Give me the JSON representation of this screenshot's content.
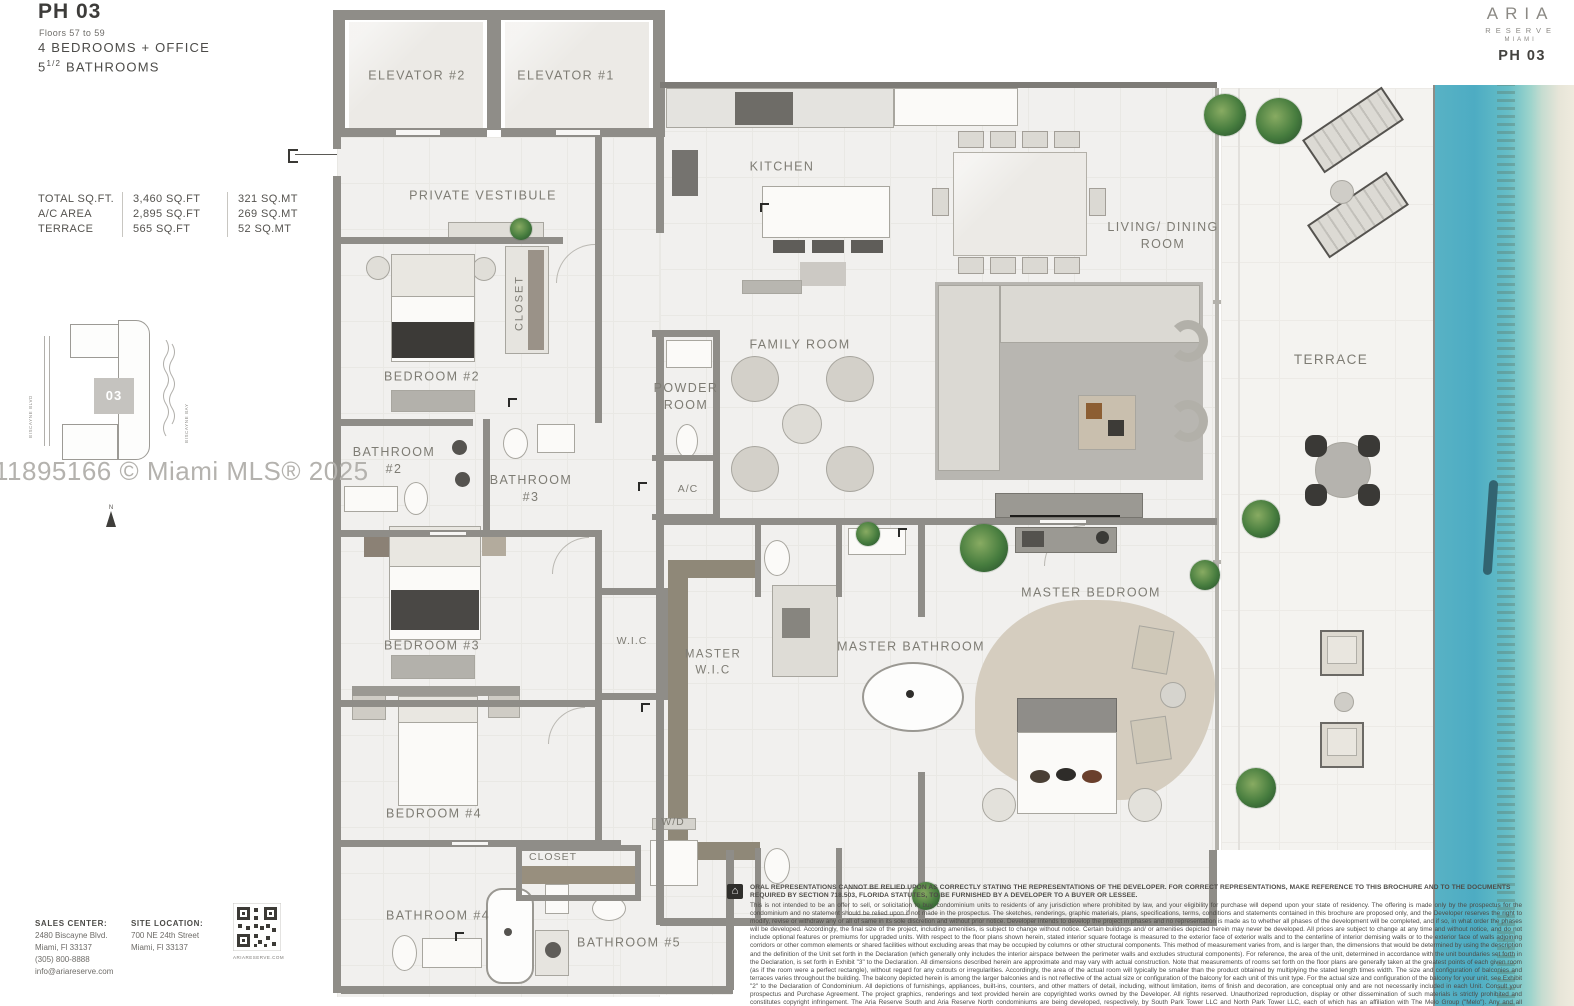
{
  "brand": {
    "name": "ARIA",
    "line2": "RESERVE",
    "line3": "MIAMI",
    "unit": "PH 03"
  },
  "left_panel": {
    "unit": "PH 03",
    "floors": "Floors 57 to 59",
    "bedrooms": "4 BEDROOMS + OFFICE",
    "bath_num": "5",
    "bath_frac": "1/2",
    "bath_word": " BATHROOMS",
    "stats": [
      {
        "label": "TOTAL SQ.FT.",
        "sqft": "3,460 SQ.FT",
        "sqmt": "321 SQ.MT"
      },
      {
        "label": "A/C AREA",
        "sqft": "2,895 SQ.FT",
        "sqmt": "269 SQ.MT"
      },
      {
        "label": "TERRACE",
        "sqft": "565 SQ.FT",
        "sqmt": "52 SQ.MT"
      }
    ],
    "site_diagram": {
      "left_label": "BISCAYNE BLVD",
      "right_label": "BISCAYNE BAY",
      "unit_number": "03",
      "north": "N"
    },
    "watermark": "11895166 © Miami MLS® 2025",
    "sales_center": {
      "title": "SALES CENTER:",
      "l1": "2480 Biscayne Blvd.",
      "l2": "Miami, Fl 33137",
      "l3": "(305) 800-8888",
      "l4": "info@ariareserve.com"
    },
    "site_location": {
      "title": "SITE LOCATION:",
      "l1": "700 NE 24th Street",
      "l2": "Miami, Fl 33137"
    },
    "qr_caption": "ARIARESERVE.COM"
  },
  "rooms": {
    "elevator2": "ELEVATOR #2",
    "elevator1": "ELEVATOR #1",
    "vestibule": "PRIVATE VESTIBULE",
    "kitchen": "KITCHEN",
    "living": "LIVING/ DINING\nROOM",
    "family": "FAMILY ROOM",
    "closet2": "CLOSET",
    "bedroom2": "BEDROOM #2",
    "powder": "POWDER\nROOM",
    "bath2": "BATHROOM\n#2",
    "bath3": "BATHROOM\n#3",
    "ac": "A/C",
    "terrace": "TERRACE",
    "bedroom3": "BEDROOM #3",
    "wic": "W.I.C",
    "master_wic": "MASTER\nW.I.C",
    "master_bath": "MASTER BATHROOM",
    "master_bed": "MASTER BEDROOM",
    "bedroom4": "BEDROOM #4",
    "wd": "W/D",
    "closet4": "CLOSET",
    "bath4": "BATHROOM #4",
    "bath5": "BATHROOM #5"
  },
  "disclaimer": {
    "headline": "ORAL REPRESENTATIONS CANNOT BE RELIED UPON AS CORRECTLY STATING THE REPRESENTATIONS OF THE DEVELOPER. FOR CORRECT REPRESENTATIONS, MAKE REFERENCE TO THIS BROCHURE AND TO THE DOCUMENTS REQUIRED BY SECTION 718.503, FLORIDA STATUTES, TO BE FURNISHED BY A DEVELOPER TO A BUYER OR LESSEE.",
    "body": "This is not intended to be an offer to sell, or solicitation to buy, condominium units to residents of any jurisdiction where prohibited by law, and your eligibility for purchase will depend upon your state of residency. The offering is made only by the prospectus for the condominium and no statement should be relied upon if not made in the prospectus. The sketches, renderings, graphic materials, plans, specifications, terms, conditions and statements contained in this brochure are proposed only, and the Developer reserves the right to modify, revise or withdraw any or all of same in its sole discretion and without prior notice. Developer intends to develop the project in phases and no representation is made as to whether all phases of the development will be completed, and if so, in what order the phases will be developed. Accordingly, the final size of the project, including amenities, is subject to change without notice. Certain buildings and/ or amenities depicted herein may never be developed. All prices are subject to change at any time and without notice, and do not include optional features or premiums for upgraded units. With respect to the floor plans shown herein, stated interior square footage is measured to the exterior face of exterior walls and to the centerline of interior demising walls or to the exterior face of walls adjoining corridors or other common elements or shared facilities without excluding areas that may be occupied by columns or other structural components. This method of measurement varies from, and is larger than, the dimensions that would be determined by using the description and the definition of the Unit set forth in the Declaration (which generally only includes the interior airspace between the perimeter walls and excludes structural components). For reference, the area of the unit, determined in accordance with the unit boundaries set forth in the Declaration, is set forth in Exhibit \"3\" to the Declaration. All dimensions described herein are approximate and may vary with actual construction. Note that measurements of rooms set forth on the floor plans are generally taken at the greatest points of each given room (as if the room were a perfect rectangle), without regard for any cutouts or irregularities. Accordingly, the area of the actual room will typically be smaller than the product obtained by multiplying the stated length times width. The size and configuration of balconies and terraces varies throughout the building. The balcony depicted herein is among the larger balconies and is not reflective of the actual size or configuration of the balcony for each unit of this unit type. For the actual size and configuration of the balcony for your unit, see Exhibit \"2\" to the Declaration of Condominium. All depictions of furnishings, appliances, built-ins, counters, and other matters of detail, including, without limitation, items of finish and decoration, are conceptual only and are not necessarily included in each Unit. Consult your prospectus and Purchase Agreement. The project graphics, renderings and text provided herein are copyrighted works owned by the Developer. All rights reserved. Unauthorized reproduction, display or other dissemination of such materials is strictly prohibited and constitutes copyright infringement. The Aria Reserve South and Aria Reserve North condominiums are being developed, respectively, by South Park Tower LLC and North Park Tower LLC, each of which has an affiliation with The Melo Group (\"Melo\"). Any and all statements, disclosures and/or representations made to purchasers in Aria Reserve South shall be deemed made by South Park Tower LLC and not by Melo, Arquitectonica or ArsGeo (collectively, the \"Associated Parties\"). Similarly, any and all statements, disclosures and/or representations made to purchasers in Aria Reserve North shall be deemed made by North Park Tower LLC and not by Melo or the Associated Parties. Purchaser agrees to look solely to the applicable Developer of the particular condominium (and not to Melo or the Associated Parties) with respect to any and all matters relating to the marketing and/or development of the applicable Condominium and with respect to the sales of Units in the applicable Condominium."
  },
  "colors": {
    "water": "#53aec3",
    "wall": "#8f8d88",
    "plant_green": "#467c3e",
    "label_gray": "#7e7c74"
  }
}
